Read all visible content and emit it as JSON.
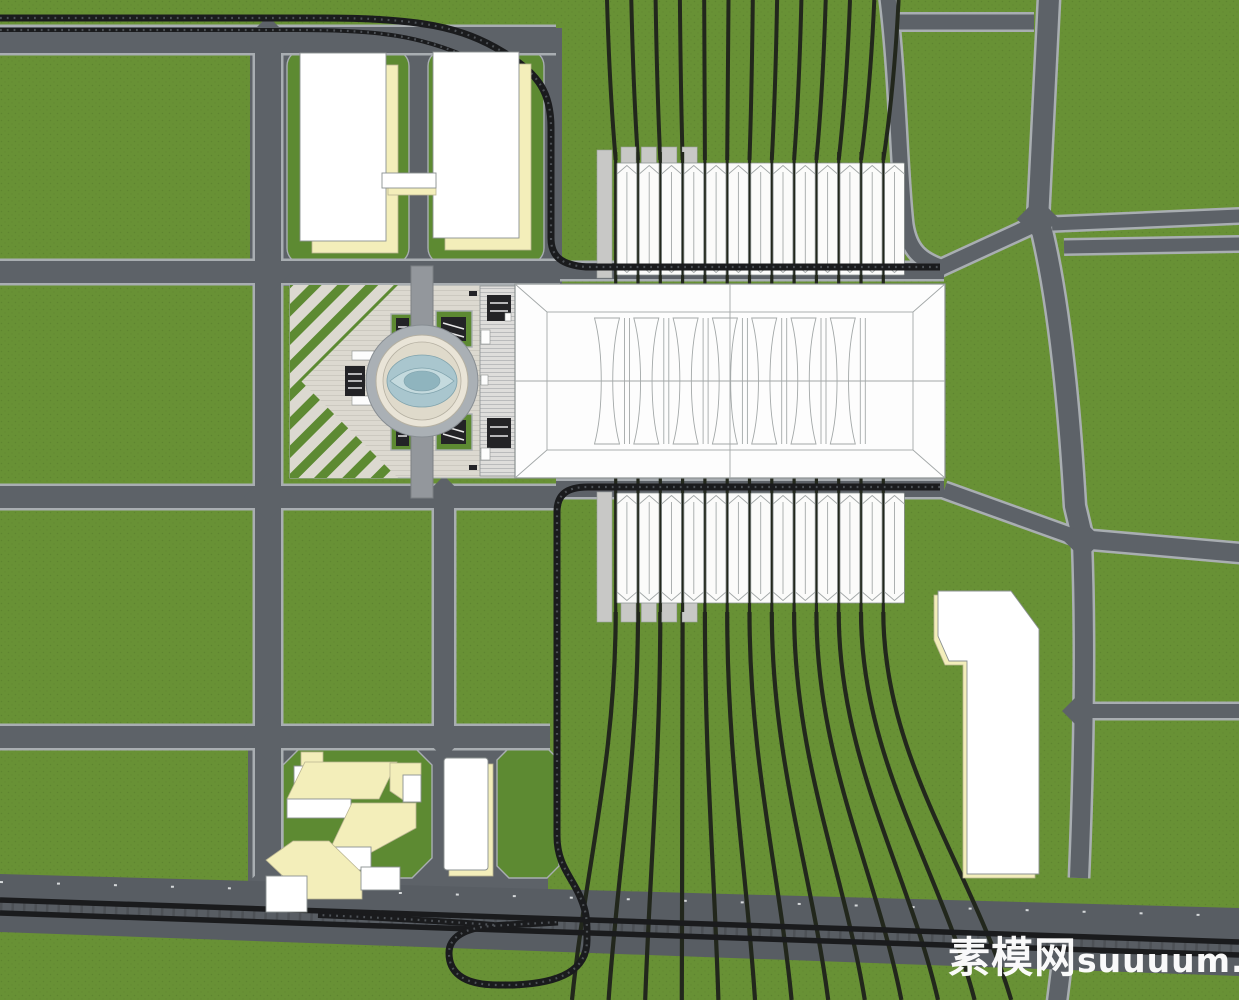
{
  "image": {
    "type": "architectural-site-plan-render",
    "description": "Top-down SketchUp-style site plan of a railway station complex: central white terminal hall flanked by 13 platform canopies north and south, fanning rail tracks, a forecourt plaza with circular fountain, cream office slabs, a numeral-1 shaped tower, and a road grid over green fields with a mainline railway and turning loop at the bottom",
    "view": "plan"
  },
  "watermark": {
    "cn": "素模网",
    "latin": "suuuum.com",
    "full": "素模网suuuum.com",
    "color": "#ffffff"
  },
  "palette": {
    "grass": "#689135",
    "grassDot": "#56792b",
    "pad": "#5d8a32",
    "road": "#5d6268",
    "curb": "#a9aeb2",
    "corridor": "#585d63",
    "rail": "#1a1b1d",
    "railMid": "#4d5156",
    "trackFan": "#22271c",
    "stationWhite": "#fdfdfd",
    "canopy": "#fbfbfa",
    "platformGray": "#c8c8c6",
    "outline": "#8b9191",
    "roofLine": "#a3a8a8",
    "plaza": "#dcd9d0",
    "plazaStripe": "#ccc9c0",
    "plazaAxis": "#93979c",
    "cream": "#f3eeba",
    "creamEdge": "#b9b491",
    "water": "#a9c6ce",
    "waterDeep": "#8fb4be",
    "deck": "#e9e4d7",
    "deckRing": "#aab0b5",
    "kiosk": "#232326",
    "post": "#d6d9db"
  },
  "station": {
    "canopy_count": 13,
    "track_count": 13,
    "roof_bay_units": 7,
    "platform_stub_count": 4
  },
  "features": {
    "terminal": "station-hall",
    "plaza": "forecourt-plaza-with-fountain",
    "north_buildings": "twin-office-slabs-with-skybridge",
    "southwest_buildings": "mixed-use-bar-cluster",
    "southeast_building": "tower-one-shaped-slab",
    "rail_bottom": "mainline-railway-with-turning-loop",
    "transit": "station-access-guideway"
  }
}
